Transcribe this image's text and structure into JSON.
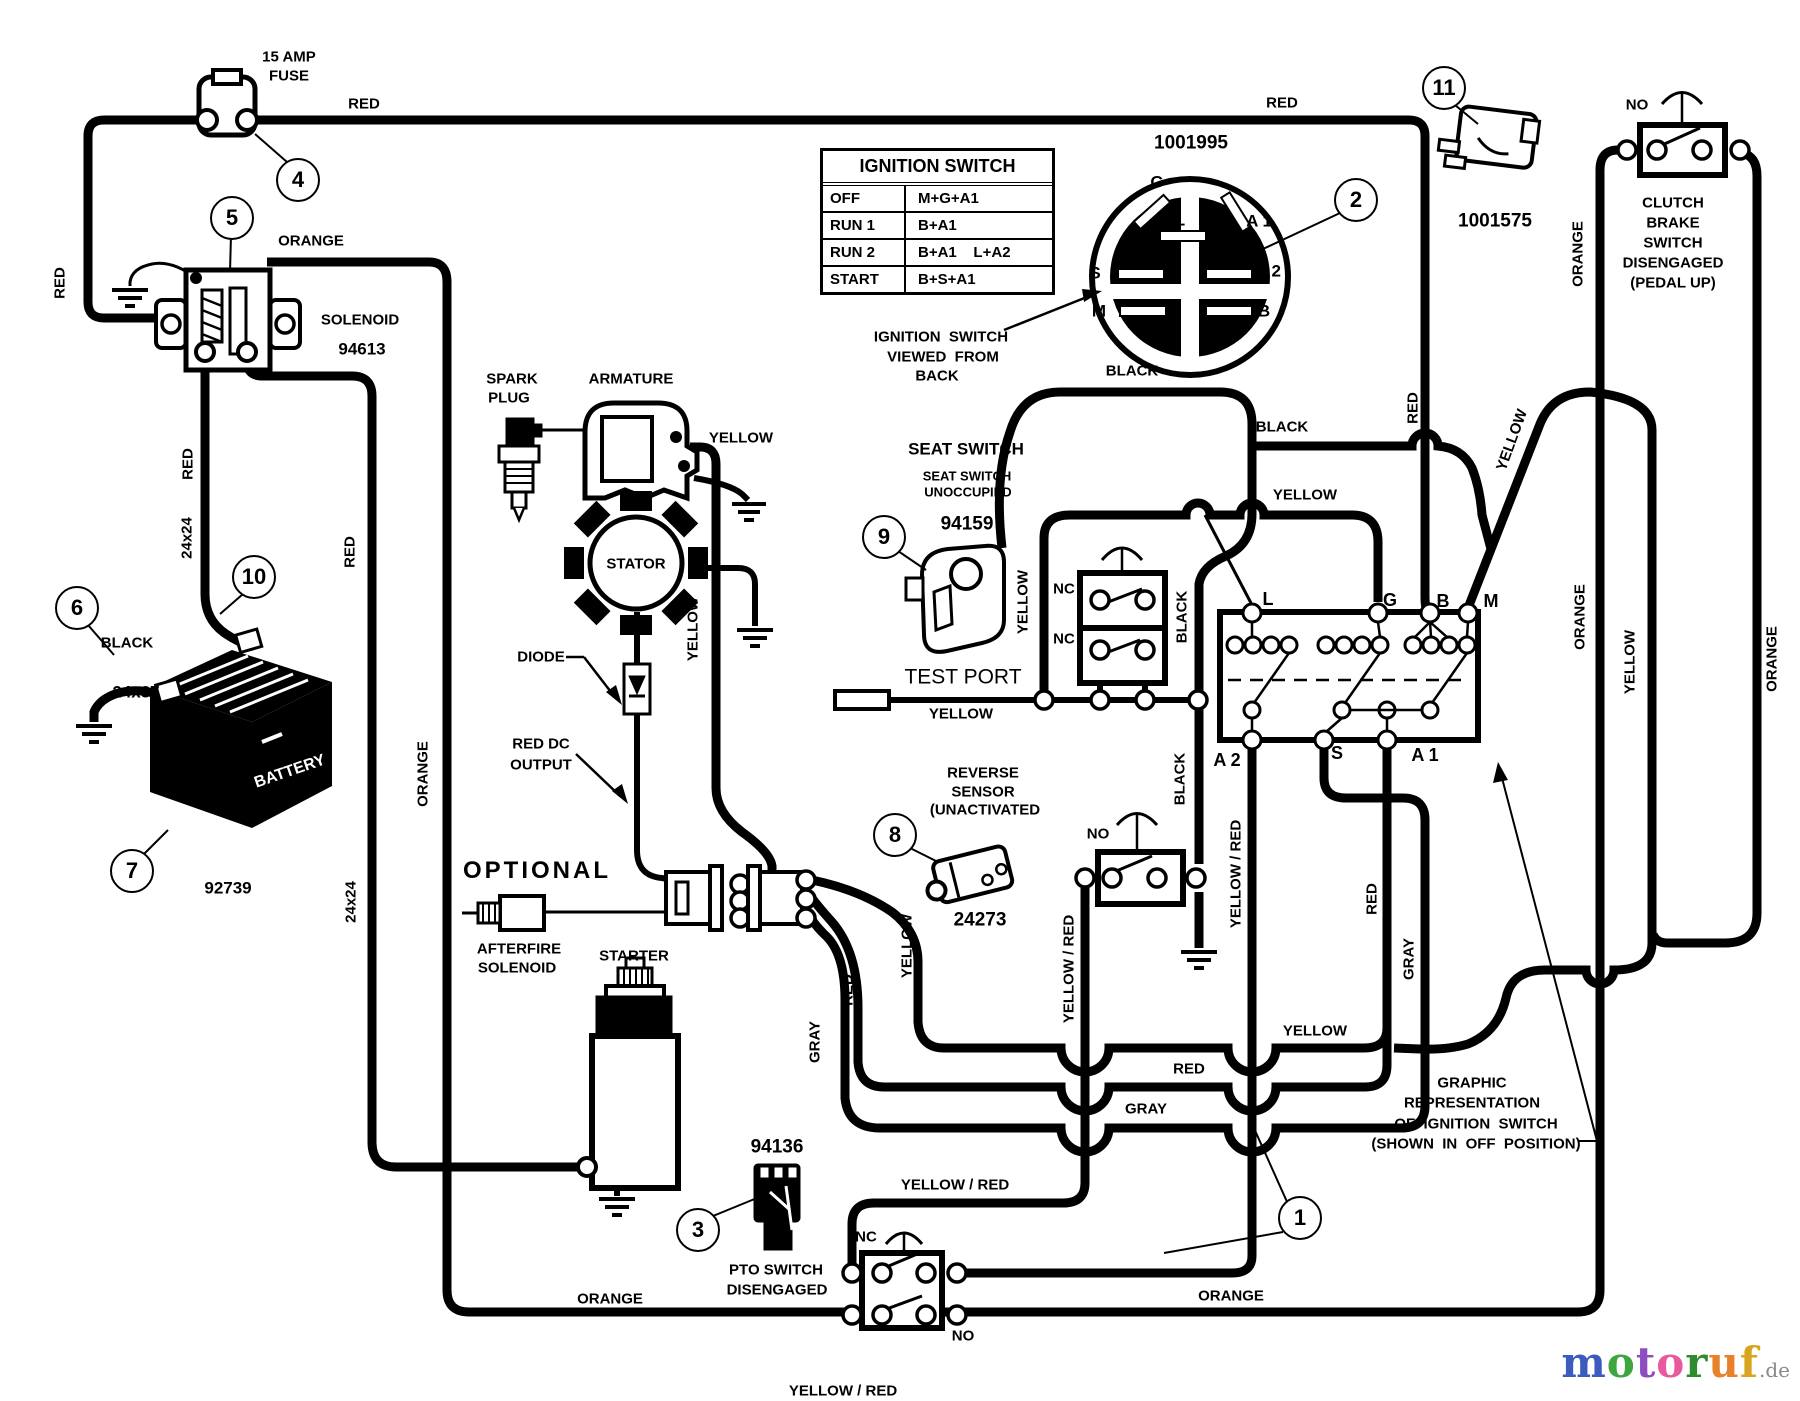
{
  "diagram": {
    "ignition_table": {
      "title": "IGNITION SWITCH",
      "rows": [
        [
          "OFF",
          "M+G+A1"
        ],
        [
          "RUN 1",
          "B+A1"
        ],
        [
          "RUN 2",
          "B+A1    L+A2"
        ],
        [
          "START",
          "B+S+A1"
        ]
      ]
    },
    "labels": [
      {
        "id": "fuse-rating-1",
        "t": "15 AMP",
        "x": 289,
        "y": 57
      },
      {
        "id": "fuse-rating-2",
        "t": "FUSE",
        "x": 289,
        "y": 76
      },
      {
        "t": "RED",
        "x": 364,
        "y": 104
      },
      {
        "t": "RED",
        "x": 1282,
        "y": 103
      },
      {
        "t": "ORANGE",
        "x": 311,
        "y": 241
      },
      {
        "id": "solenoid-name",
        "t": "SOLENOID",
        "x": 360,
        "y": 320
      },
      {
        "id": "solenoid-part",
        "t": "94613",
        "x": 362,
        "y": 349,
        "fs": 17
      },
      {
        "t": "RED",
        "x": 60,
        "y": 283,
        "r": -90
      },
      {
        "t": "RED",
        "x": 188,
        "y": 464,
        "r": -90
      },
      {
        "t": "24x24",
        "x": 187,
        "y": 538,
        "r": -90
      },
      {
        "t": "BLACK",
        "x": 127,
        "y": 643
      },
      {
        "t": "24x37",
        "x": 136,
        "y": 692,
        "fs": 17
      },
      {
        "id": "battery-part",
        "t": "92739",
        "x": 228,
        "y": 888,
        "fs": 17
      },
      {
        "id": "battery-name",
        "t": "BATTERY",
        "x": 290,
        "y": 772,
        "r": -19,
        "fs": 16,
        "c": "#ffffff"
      },
      {
        "t": "RED",
        "x": 350,
        "y": 552,
        "r": -90
      },
      {
        "t": "24x24",
        "x": 351,
        "y": 902,
        "r": -90
      },
      {
        "t": "ORANGE",
        "x": 423,
        "y": 774,
        "r": -90
      },
      {
        "id": "spark-plug-name-1",
        "t": "SPARK",
        "x": 512,
        "y": 379
      },
      {
        "id": "spark-plug-name-2",
        "t": "PLUG",
        "x": 509,
        "y": 398
      },
      {
        "id": "armature-name",
        "t": "ARMATURE",
        "x": 631,
        "y": 379
      },
      {
        "t": "YELLOW",
        "x": 741,
        "y": 438
      },
      {
        "id": "stator-name",
        "t": "STATOR",
        "x": 636,
        "y": 564
      },
      {
        "id": "diode-name",
        "t": "DIODE",
        "x": 541,
        "y": 657
      },
      {
        "t": "YELLOW",
        "x": 693,
        "y": 629,
        "r": -90
      },
      {
        "id": "red-dc-1",
        "t": "RED DC",
        "x": 541,
        "y": 744
      },
      {
        "id": "red-dc-2",
        "t": "OUTPUT",
        "x": 541,
        "y": 765
      },
      {
        "id": "optional",
        "t": "OPTIONAL",
        "x": 537,
        "y": 871,
        "fs": 24,
        "ls": 3
      },
      {
        "id": "afterfire-1",
        "t": "AFTERFIRE",
        "x": 519,
        "y": 949
      },
      {
        "id": "afterfire-2",
        "t": "SOLENOID",
        "x": 517,
        "y": 968
      },
      {
        "id": "starter-name",
        "t": "STARTER",
        "x": 634,
        "y": 956
      },
      {
        "id": "pto-part",
        "t": "94136",
        "x": 777,
        "y": 1147,
        "fs": 19
      },
      {
        "id": "pto-name-1",
        "t": "PTO SWITCH",
        "x": 776,
        "y": 1270
      },
      {
        "id": "pto-name-2",
        "t": "DISENGAGED",
        "x": 777,
        "y": 1290
      },
      {
        "t": "ORANGE",
        "x": 610,
        "y": 1299
      },
      {
        "t": "ORANGE",
        "x": 1231,
        "y": 1296
      },
      {
        "t": "NC",
        "x": 866,
        "y": 1237
      },
      {
        "t": "NO",
        "x": 963,
        "y": 1336
      },
      {
        "t": "YELLOW / RED",
        "x": 955,
        "y": 1185
      },
      {
        "t": "YELLOW / RED",
        "x": 843,
        "y": 1391
      },
      {
        "t": "GRAY",
        "x": 815,
        "y": 1042,
        "r": -90
      },
      {
        "t": "RED",
        "x": 848,
        "y": 990,
        "r": -90
      },
      {
        "t": "YELLOW",
        "x": 907,
        "y": 946,
        "r": -90
      },
      {
        "id": "reverse-part",
        "t": "24273",
        "x": 980,
        "y": 920,
        "fs": 19
      },
      {
        "id": "reverse-name-1",
        "t": "REVERSE",
        "x": 983,
        "y": 773
      },
      {
        "id": "reverse-name-2",
        "t": "SENSOR",
        "x": 983,
        "y": 792
      },
      {
        "id": "reverse-name-3",
        "t": "(UNACTIVATED",
        "x": 985,
        "y": 810
      },
      {
        "t": "NO",
        "x": 1098,
        "y": 834
      },
      {
        "t": "YELLOW / RED",
        "x": 1069,
        "y": 969,
        "r": -90
      },
      {
        "t": "BLACK",
        "x": 1180,
        "y": 779,
        "r": -90
      },
      {
        "t": "YELLOW / RED",
        "x": 1236,
        "y": 874,
        "r": -90
      },
      {
        "id": "seat-name",
        "t": "SEAT SWITCH",
        "x": 966,
        "y": 449,
        "fs": 17
      },
      {
        "id": "seat-state-1",
        "t": "SEAT SWITCH",
        "x": 967,
        "y": 476,
        "fs": 13
      },
      {
        "id": "seat-state-2",
        "t": "UNOCCUPIED",
        "x": 968,
        "y": 492,
        "fs": 13
      },
      {
        "id": "seat-part",
        "t": "94159",
        "x": 967,
        "y": 524,
        "fs": 19
      },
      {
        "t": "YELLOW",
        "x": 1023,
        "y": 602,
        "r": -90
      },
      {
        "t": "NC",
        "x": 1064,
        "y": 589
      },
      {
        "t": "NC",
        "x": 1064,
        "y": 639
      },
      {
        "t": "BLACK",
        "x": 1182,
        "y": 617,
        "r": -90
      },
      {
        "id": "test-port",
        "t": "TEST PORT",
        "x": 963,
        "y": 677,
        "fs": 21,
        "w": 400
      },
      {
        "t": "YELLOW",
        "x": 961,
        "y": 714
      },
      {
        "t": "BLACK",
        "x": 1132,
        "y": 371
      },
      {
        "t": "BLACK",
        "x": 1282,
        "y": 427
      },
      {
        "t": "YELLOW",
        "x": 1305,
        "y": 495
      },
      {
        "t": "RED",
        "x": 1413,
        "y": 408,
        "r": -90
      },
      {
        "t": "YELLOW",
        "x": 1512,
        "y": 440,
        "r": -70
      },
      {
        "t": "ORANGE",
        "x": 1578,
        "y": 254,
        "r": -90
      },
      {
        "t": "ORANGE",
        "x": 1580,
        "y": 617,
        "r": -90
      },
      {
        "t": "YELLOW",
        "x": 1630,
        "y": 662,
        "r": -90
      },
      {
        "t": "ORANGE",
        "x": 1772,
        "y": 659,
        "r": -90
      },
      {
        "t": "NO",
        "x": 1637,
        "y": 105
      },
      {
        "id": "clutch-1",
        "t": "CLUTCH",
        "x": 1673,
        "y": 203
      },
      {
        "id": "clutch-2",
        "t": "BRAKE",
        "x": 1673,
        "y": 223
      },
      {
        "id": "clutch-3",
        "t": "SWITCH",
        "x": 1673,
        "y": 243
      },
      {
        "id": "clutch-4",
        "t": "DISENGAGED",
        "x": 1673,
        "y": 263
      },
      {
        "id": "clutch-5",
        "t": "(PEDAL UP)",
        "x": 1673,
        "y": 283
      },
      {
        "id": "clutch-part",
        "t": "1001575",
        "x": 1495,
        "y": 221,
        "fs": 19
      },
      {
        "id": "ignition-part",
        "t": "1001995",
        "x": 1191,
        "y": 143,
        "fs": 19
      },
      {
        "id": "ign-view-1",
        "t": "IGNITION  SWITCH",
        "x": 941,
        "y": 337
      },
      {
        "id": "ign-view-2",
        "t": "VIEWED  FROM",
        "x": 943,
        "y": 357
      },
      {
        "id": "ign-view-3",
        "t": "BACK",
        "x": 937,
        "y": 376
      },
      {
        "t": "YELLOW",
        "x": 1315,
        "y": 1031
      },
      {
        "t": "RED",
        "x": 1189,
        "y": 1069
      },
      {
        "t": "GRAY",
        "x": 1146,
        "y": 1109
      },
      {
        "t": "RED",
        "x": 1372,
        "y": 899,
        "r": -90
      },
      {
        "t": "GRAY",
        "x": 1409,
        "y": 959,
        "r": -90
      },
      {
        "id": "term-L",
        "t": "L",
        "x": 1268,
        "y": 599,
        "fs": 18
      },
      {
        "id": "term-G",
        "t": "G",
        "x": 1390,
        "y": 600,
        "fs": 18
      },
      {
        "id": "term-B",
        "t": "B",
        "x": 1443,
        "y": 601,
        "fs": 18
      },
      {
        "id": "term-M",
        "t": "M",
        "x": 1491,
        "y": 601,
        "fs": 18
      },
      {
        "id": "term-A2",
        "t": "A 2",
        "x": 1227,
        "y": 760,
        "fs": 18
      },
      {
        "id": "term-S",
        "t": "S",
        "x": 1337,
        "y": 753,
        "fs": 18
      },
      {
        "id": "term-A1",
        "t": "A 1",
        "x": 1425,
        "y": 755,
        "fs": 18
      },
      {
        "id": "face-G",
        "t": "G",
        "x": 1157,
        "y": 182,
        "fs": 17
      },
      {
        "id": "face-L",
        "t": "L",
        "x": 1180,
        "y": 220,
        "fs": 17
      },
      {
        "id": "face-A1",
        "t": "A 1",
        "x": 1259,
        "y": 221,
        "fs": 17
      },
      {
        "id": "face-S",
        "t": "S",
        "x": 1095,
        "y": 273,
        "fs": 17
      },
      {
        "id": "face-A2",
        "t": "A 2",
        "x": 1268,
        "y": 271,
        "fs": 17
      },
      {
        "id": "face-M",
        "t": "M",
        "x": 1099,
        "y": 311,
        "fs": 17
      },
      {
        "id": "face-B",
        "t": "B",
        "x": 1264,
        "y": 311,
        "fs": 17
      },
      {
        "id": "graphic-1",
        "t": "GRAPHIC",
        "x": 1472,
        "y": 1083
      },
      {
        "id": "graphic-2",
        "t": "REPRESENTATION",
        "x": 1472,
        "y": 1103
      },
      {
        "id": "graphic-3",
        "t": "OF  IGNITION  SWITCH",
        "x": 1476,
        "y": 1124
      },
      {
        "id": "graphic-4",
        "t": "(SHOWN  IN  OFF  POSITION)",
        "x": 1476,
        "y": 1144
      }
    ],
    "callouts": [
      {
        "n": "1",
        "x": 1300,
        "y": 1218
      },
      {
        "n": "2",
        "x": 1356,
        "y": 200
      },
      {
        "n": "3",
        "x": 698,
        "y": 1230
      },
      {
        "n": "4",
        "x": 298,
        "y": 180
      },
      {
        "n": "5",
        "x": 232,
        "y": 218
      },
      {
        "n": "6",
        "x": 77,
        "y": 608
      },
      {
        "n": "7",
        "x": 132,
        "y": 871
      },
      {
        "n": "8",
        "x": 895,
        "y": 835
      },
      {
        "n": "9",
        "x": 884,
        "y": 537
      },
      {
        "n": "10",
        "x": 254,
        "y": 577
      },
      {
        "n": "11",
        "x": 1444,
        "y": 88
      }
    ],
    "logo": {
      "letters": [
        {
          "ch": "m",
          "color": "#3b5bbf"
        },
        {
          "ch": "o",
          "color": "#3fa53f"
        },
        {
          "ch": "t",
          "color": "#8d4fc0"
        },
        {
          "ch": "o",
          "color": "#e85a9b"
        },
        {
          "ch": "r",
          "color": "#2e8b2e"
        },
        {
          "ch": "u",
          "color": "#e8822a"
        },
        {
          "ch": "f",
          "color": "#d9a51e"
        }
      ],
      "suffix": ".de"
    }
  }
}
